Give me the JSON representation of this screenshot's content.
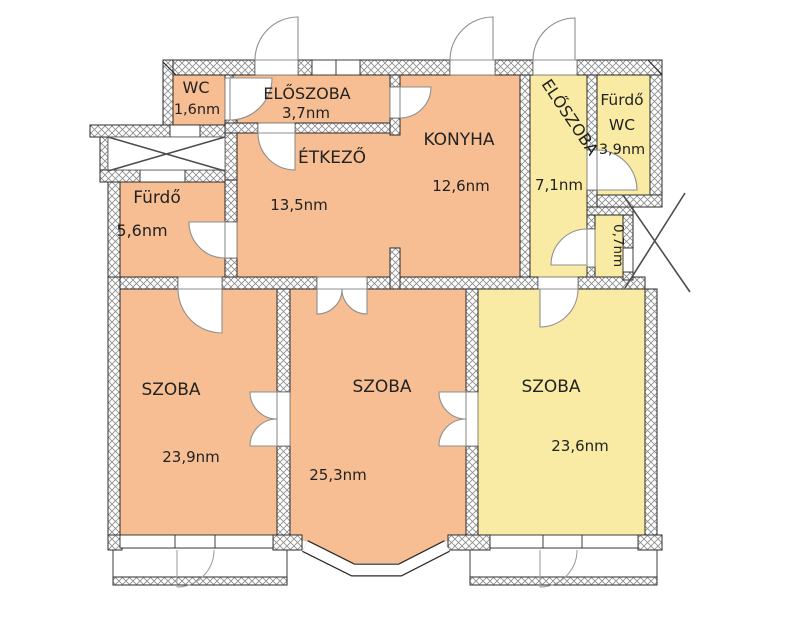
{
  "palette": {
    "room_warm": "#F6BE92",
    "room_cool": "#FAEBA4",
    "wall_line": "#2b2b2b",
    "door_line": "#8f8f8f"
  },
  "rooms": {
    "wc": {
      "name": "WC",
      "area": "1,6nm"
    },
    "eloszoba_small": {
      "name": "ELŐSZOBA",
      "area": "3,7nm"
    },
    "etkezo": {
      "name": "ÉTKEZŐ",
      "area": "13,5nm"
    },
    "konyha": {
      "name": "KONYHA",
      "area": "12,6nm"
    },
    "eloszoba_main": {
      "name": "ELŐSZOBA",
      "area": "7,1nm"
    },
    "furdo_wc": {
      "name": "Fürdő",
      "name2": "WC",
      "area": "3,9nm"
    },
    "furdo": {
      "name": "Fürdő",
      "area": "5,6nm"
    },
    "kamra": {
      "area": "0,7nm"
    },
    "szoba_left": {
      "name": "SZOBA",
      "area": "23,9nm"
    },
    "szoba_middle": {
      "name": "SZOBA",
      "area": "25,3nm"
    },
    "szoba_right": {
      "name": "SZOBA",
      "area": "23,6nm"
    }
  }
}
